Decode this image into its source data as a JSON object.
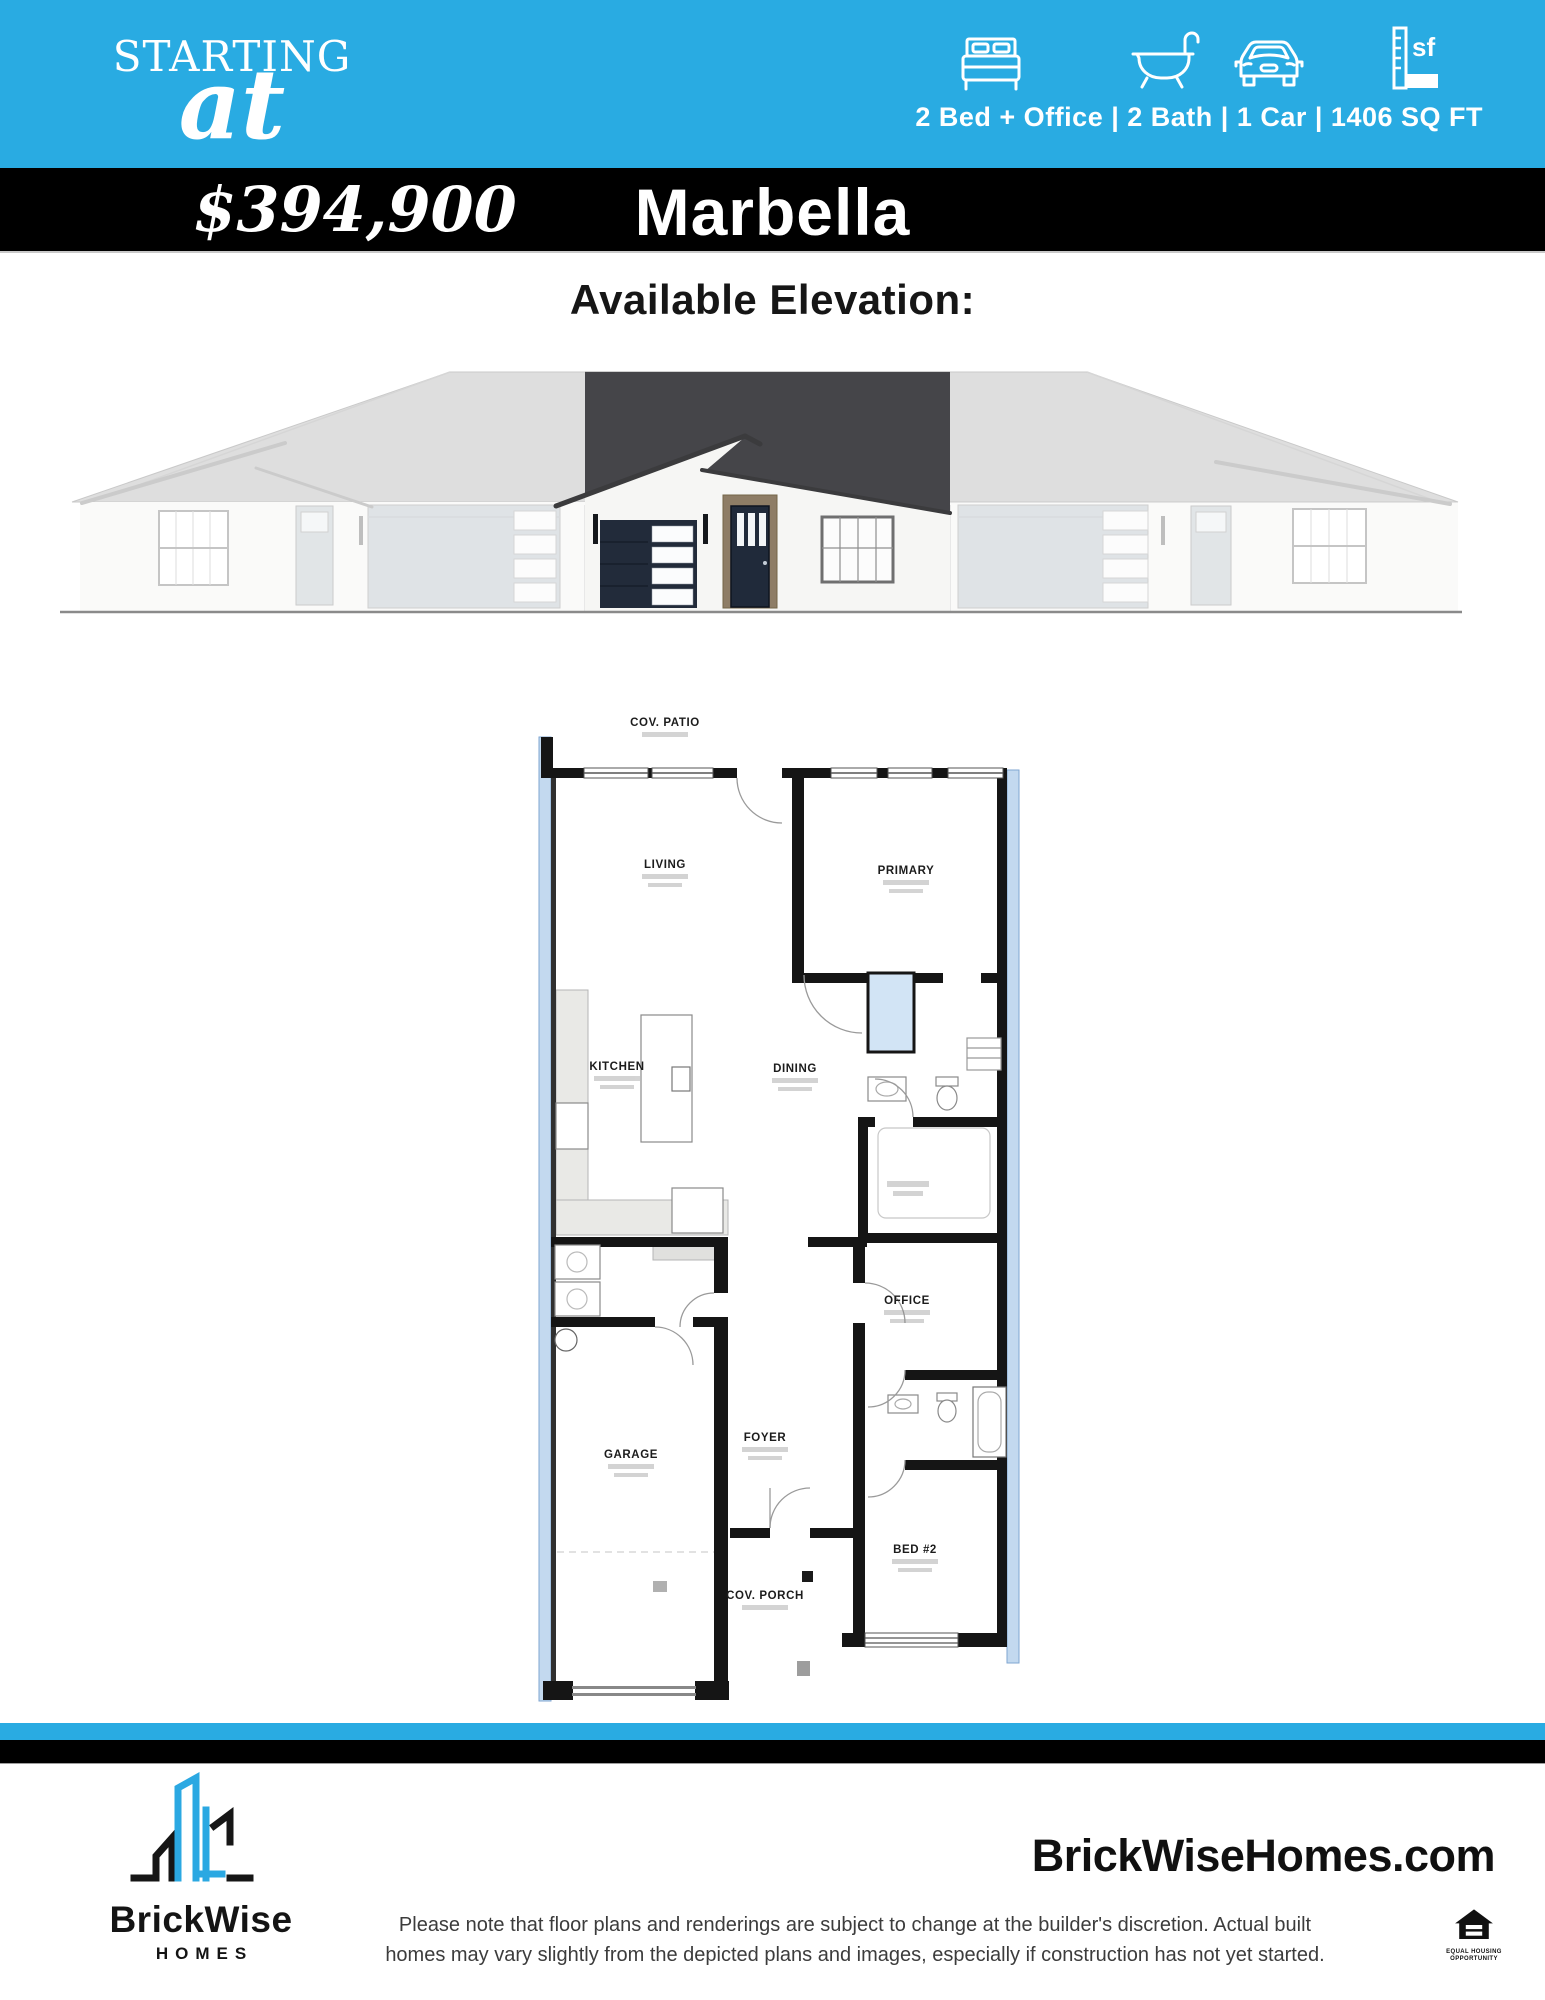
{
  "colors": {
    "accent_blue": "#29ABE2",
    "bar_black": "#000000",
    "logo_blue": "#2BA8E2"
  },
  "header": {
    "starting_label": "STARTING",
    "at_label": "at",
    "price": "$394,900",
    "plan_name": "Marbella",
    "specs": "2 Bed + Office | 2 Bath | 1 Car | 1406 SQ FT",
    "icons": [
      {
        "name": "bed-icon"
      },
      {
        "name": "bath-icon"
      },
      {
        "name": "car-icon"
      },
      {
        "name": "sqft-ruler-icon",
        "label": "sf"
      }
    ]
  },
  "elevation": {
    "heading": "Available Elevation:"
  },
  "floorplan": {
    "rooms": [
      {
        "label": "COV. PATIO"
      },
      {
        "label": "LIVING"
      },
      {
        "label": "PRIMARY"
      },
      {
        "label": "KITCHEN"
      },
      {
        "label": "DINING"
      },
      {
        "label": "OFFICE"
      },
      {
        "label": "GARAGE"
      },
      {
        "label": "FOYER"
      },
      {
        "label": "BED #2"
      },
      {
        "label": "COV. PORCH"
      }
    ]
  },
  "footer": {
    "brand_name": "BrickWise",
    "brand_sub": "HOMES",
    "website": "BrickWiseHomes.com",
    "disclaimer_line1": "Please note that floor plans and renderings are subject to change at the builder's discretion. Actual built",
    "disclaimer_line2": "homes may vary slightly from the depicted plans and images, especially if construction has not yet started.",
    "eho_line1": "EQUAL HOUSING",
    "eho_line2": "OPPORTUNITY"
  }
}
